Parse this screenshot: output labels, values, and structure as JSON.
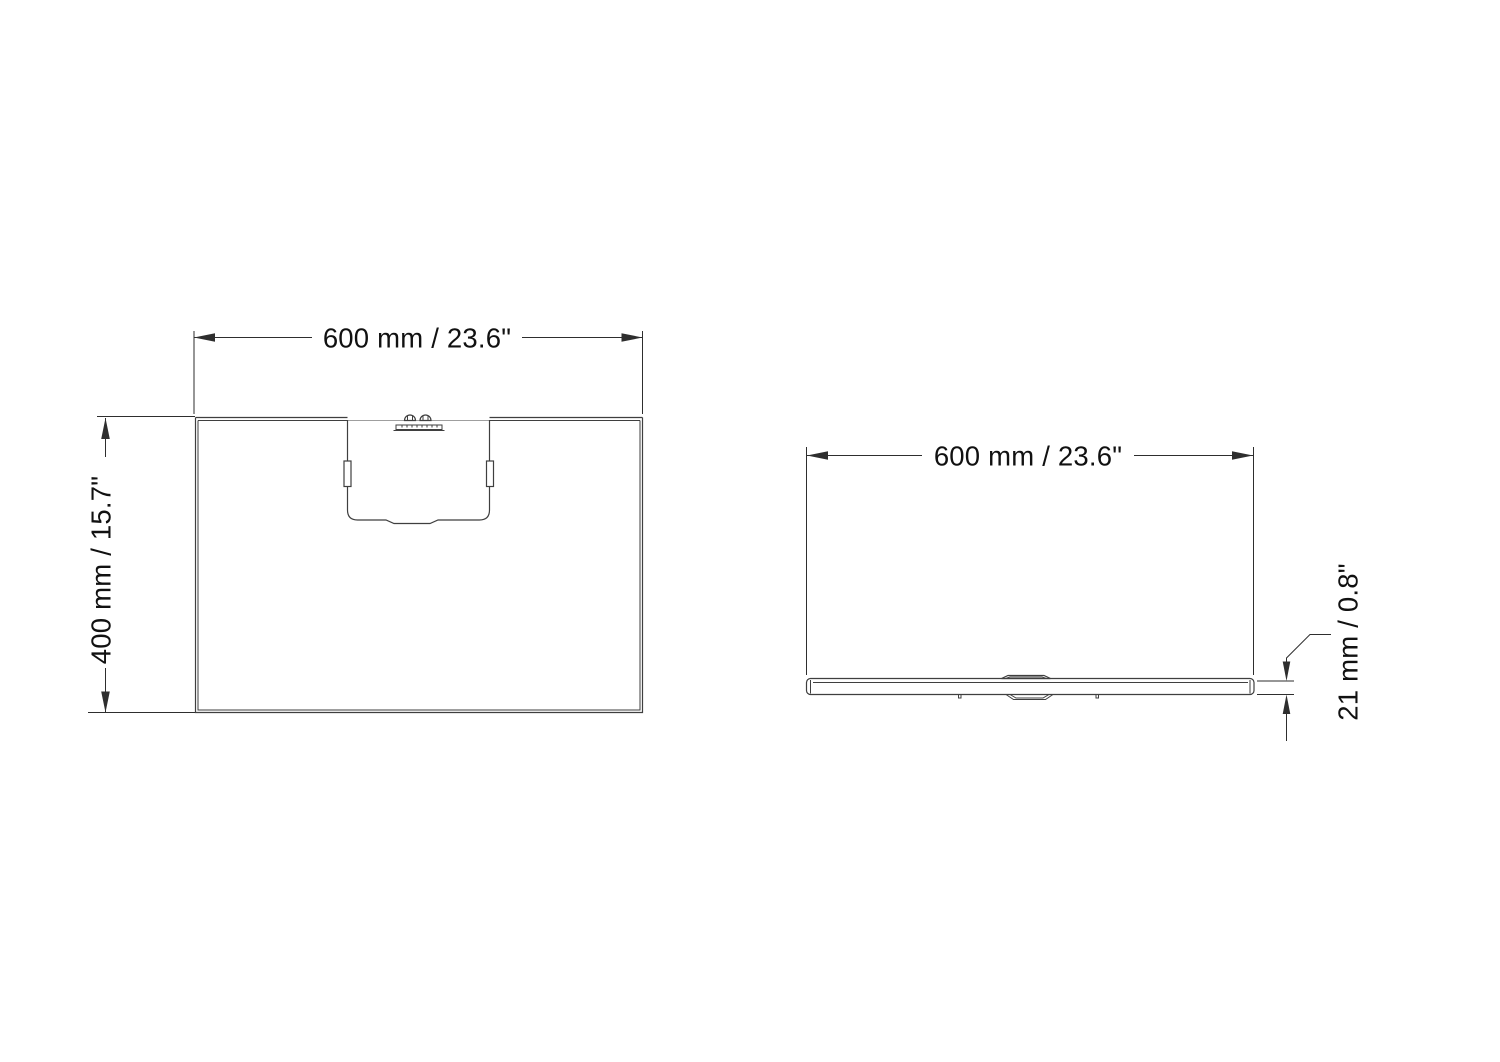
{
  "colors": {
    "background": "#ffffff",
    "line": "#3f3f3f",
    "dim": "#2e2e2e",
    "text": "#111111"
  },
  "top_view": {
    "width_label": "600 mm / 23.6\"",
    "height_label": "400 mm / 15.7\""
  },
  "front_view": {
    "width_label": "600 mm / 23.6\"",
    "thickness_label": "21 mm / 0.8\""
  }
}
